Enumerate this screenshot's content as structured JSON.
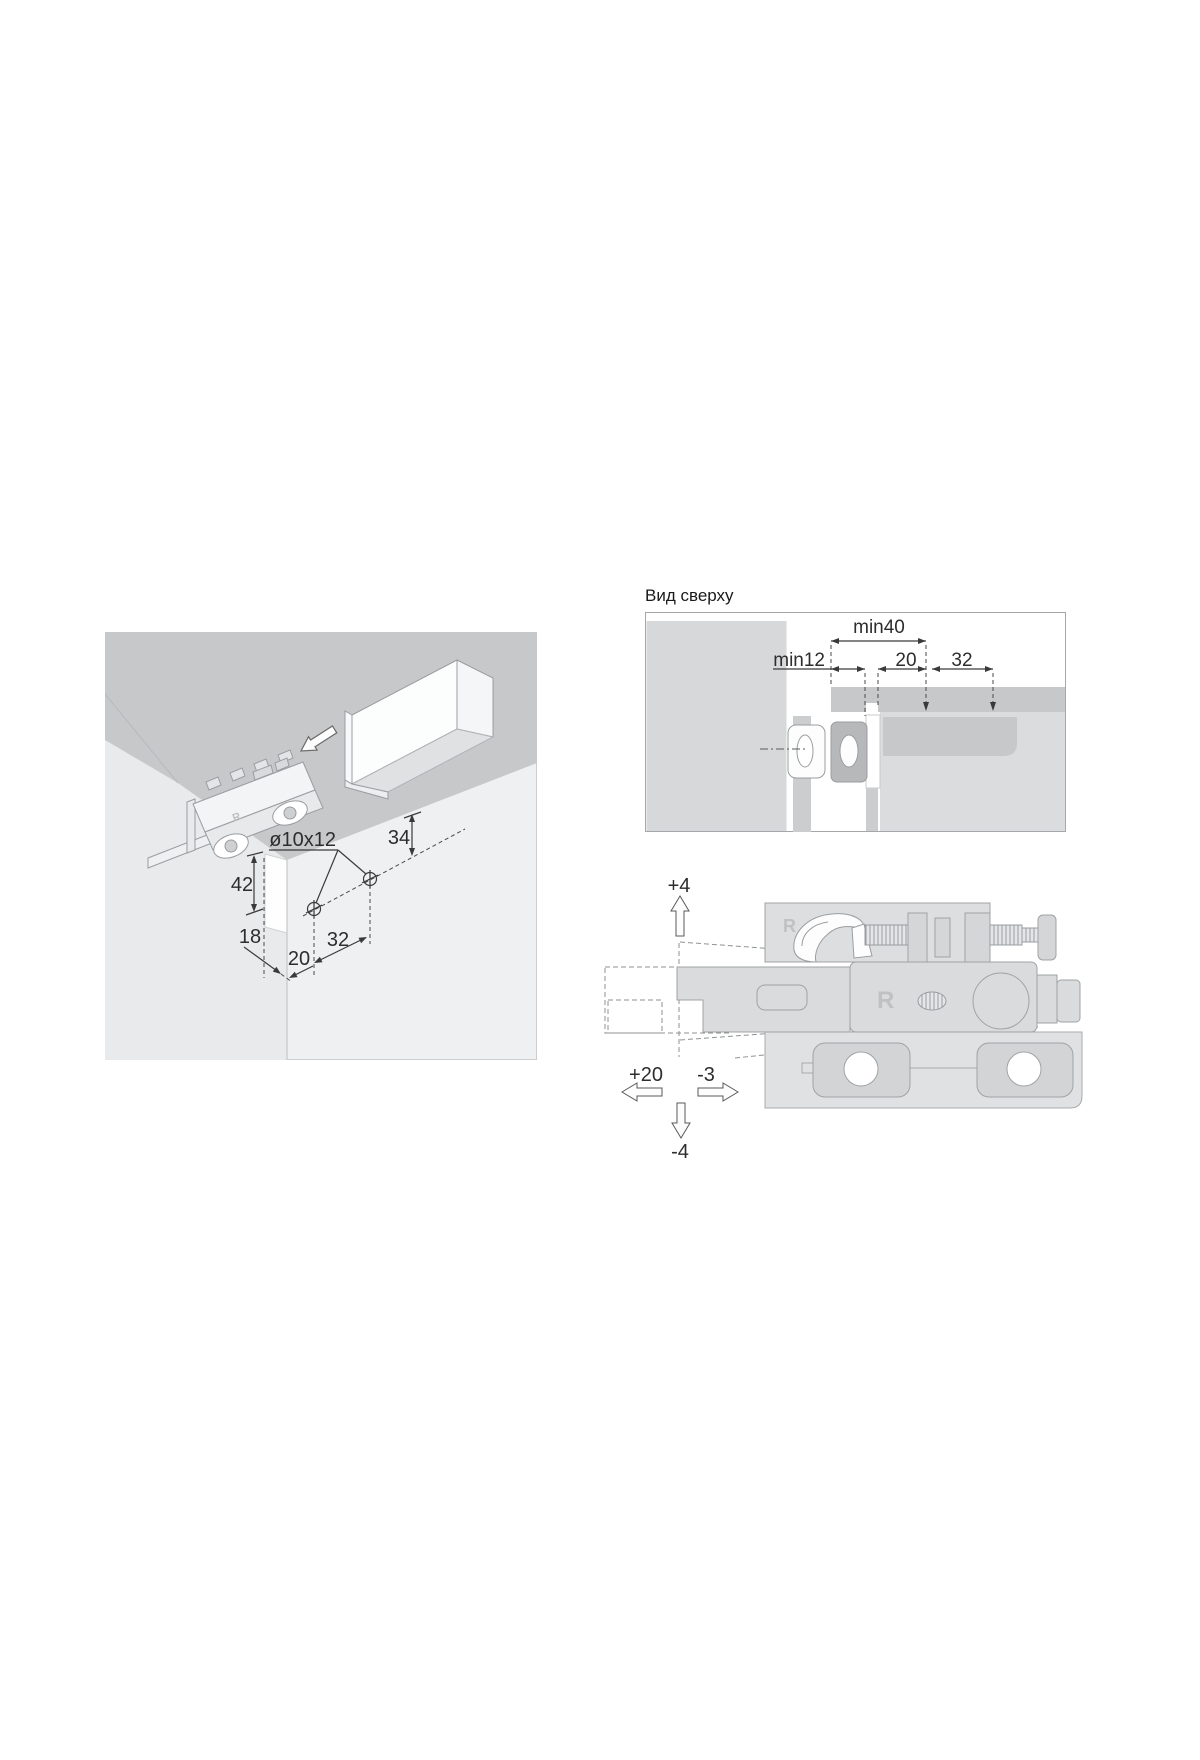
{
  "colors": {
    "wall_gray": "#c6c8ca",
    "panel_bg": "#eef0f1",
    "rail_bar_gray": "#c6c8ca",
    "light_block_gray": "#dadcde",
    "outline_gray": "#9a9da0",
    "dimension_color": "#3a3a3a",
    "background": "#ffffff"
  },
  "isometric": {
    "hole_label": "ø10x12",
    "dim_top_offset": "34",
    "dim_side_height": "42",
    "dim_front_offset": "18",
    "dim_corner_offset": "20",
    "dim_hole_spacing": "32",
    "bracket_marking": "R"
  },
  "top_view": {
    "title": "Вид сверху",
    "dim_min40": "min40",
    "dim_min12": "min12",
    "dim_20": "20",
    "dim_32": "32"
  },
  "side_view": {
    "adjust_up": "+4",
    "adjust_down": "-4",
    "adjust_left": "+20",
    "adjust_right": "-3",
    "marking_top": "R",
    "marking_body": "R"
  }
}
